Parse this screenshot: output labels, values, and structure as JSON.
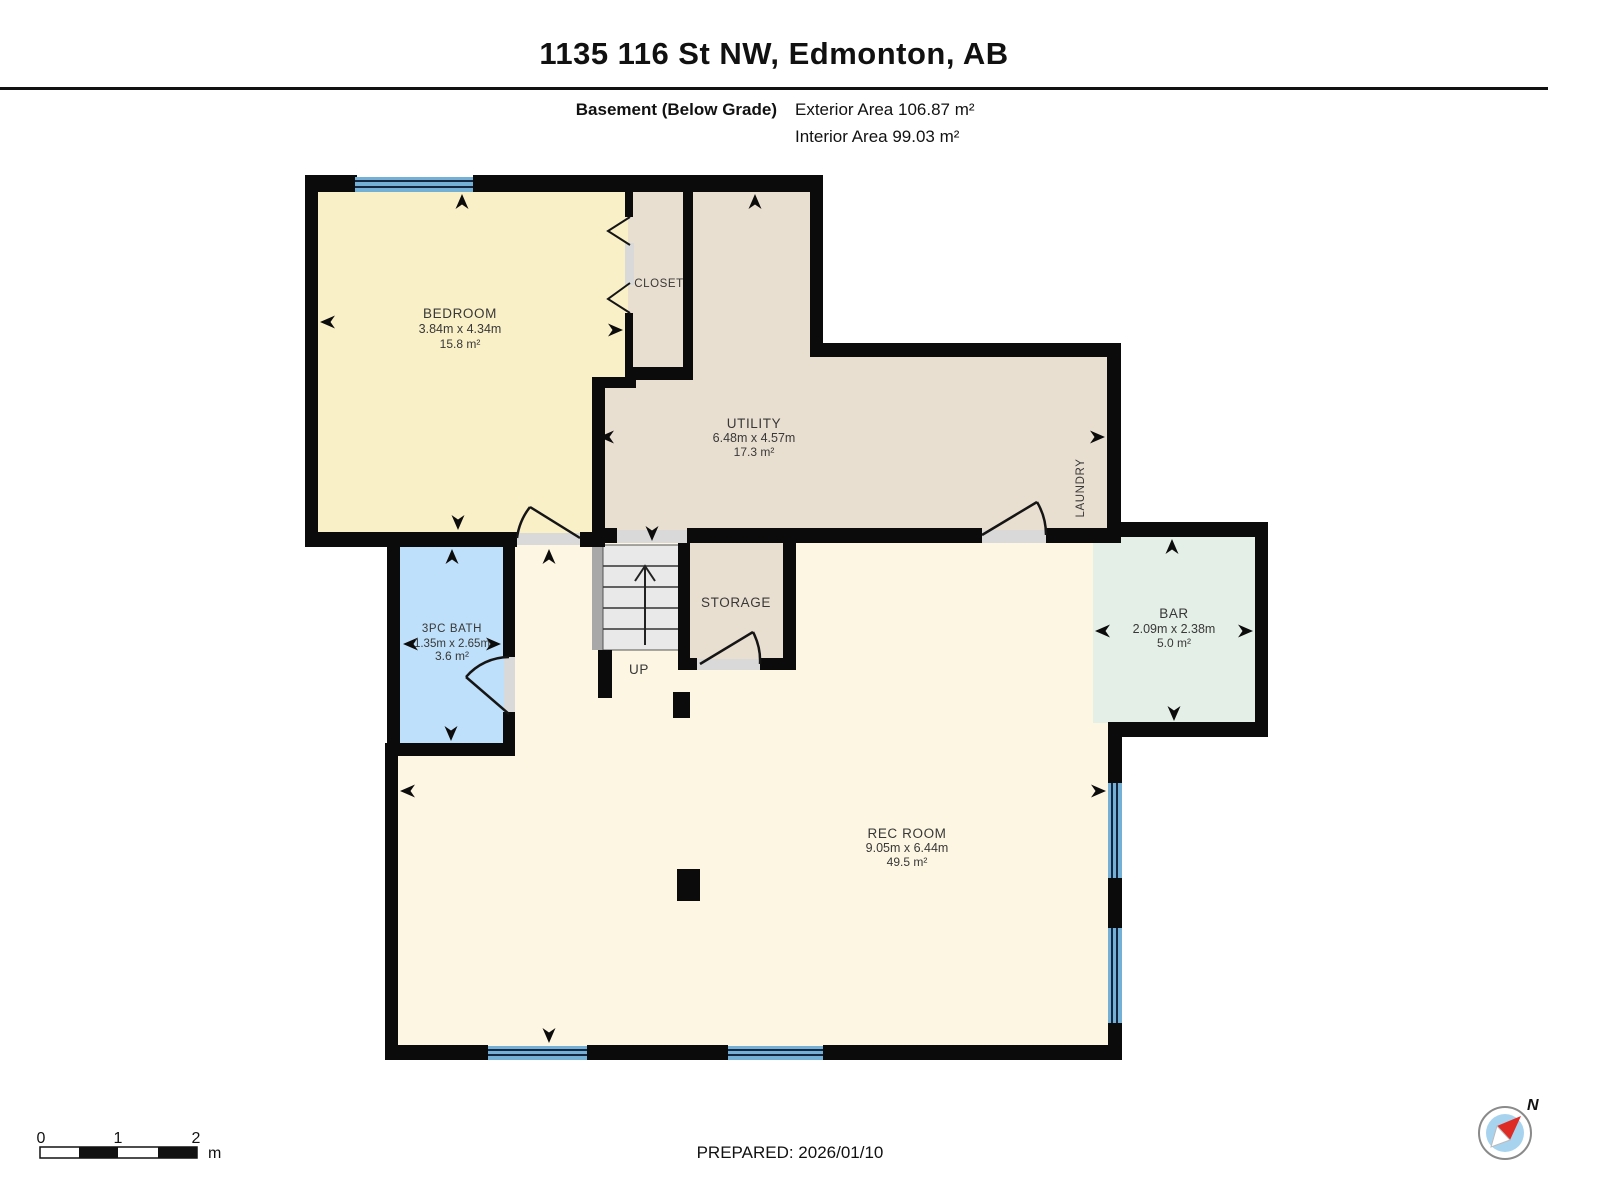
{
  "header": {
    "title": "1135 116 St NW, Edmonton, AB",
    "floor_label": "Basement (Below Grade)",
    "exterior_area": "Exterior Area 106.87 m²",
    "interior_area": "Interior Area 99.03 m²"
  },
  "rooms": {
    "bedroom": {
      "name": "BEDROOM",
      "dims": "3.84m x 4.34m",
      "area": "15.8 m²"
    },
    "closet": {
      "name": "CLOSET"
    },
    "utility": {
      "name": "UTILITY",
      "dims": "6.48m x 4.57m",
      "area": "17.3 m²"
    },
    "laundry": {
      "name": "LAUNDRY"
    },
    "bath": {
      "name": "3PC BATH",
      "dims": "1.35m x 2.65m",
      "area": "3.6 m²"
    },
    "storage": {
      "name": "STORAGE"
    },
    "stairs": {
      "label": "UP"
    },
    "bar": {
      "name": "BAR",
      "dims": "2.09m x 2.38m",
      "area": "5.0 m²"
    },
    "rec_room": {
      "name": "REC ROOM",
      "dims": "9.05m x 6.44m",
      "area": "49.5 m²"
    }
  },
  "footer": {
    "prepared": "PREPARED: 2026/01/10",
    "scale": {
      "tick0": "0",
      "tick1": "1",
      "tick2": "2",
      "unit": "m"
    },
    "compass": {
      "label": "N"
    }
  },
  "colors": {
    "wall": "#0b0b0b",
    "bedroom": "#faf0c8",
    "tan": "#e9dfd1",
    "bath": "#bfe0fa",
    "bar": "#e4efe7",
    "rec": "#fdf6e3",
    "window": "#74b0d6",
    "window_line": "#15253f",
    "compass_red": "#de2b26",
    "compass_blue": "#a7d3ef"
  }
}
